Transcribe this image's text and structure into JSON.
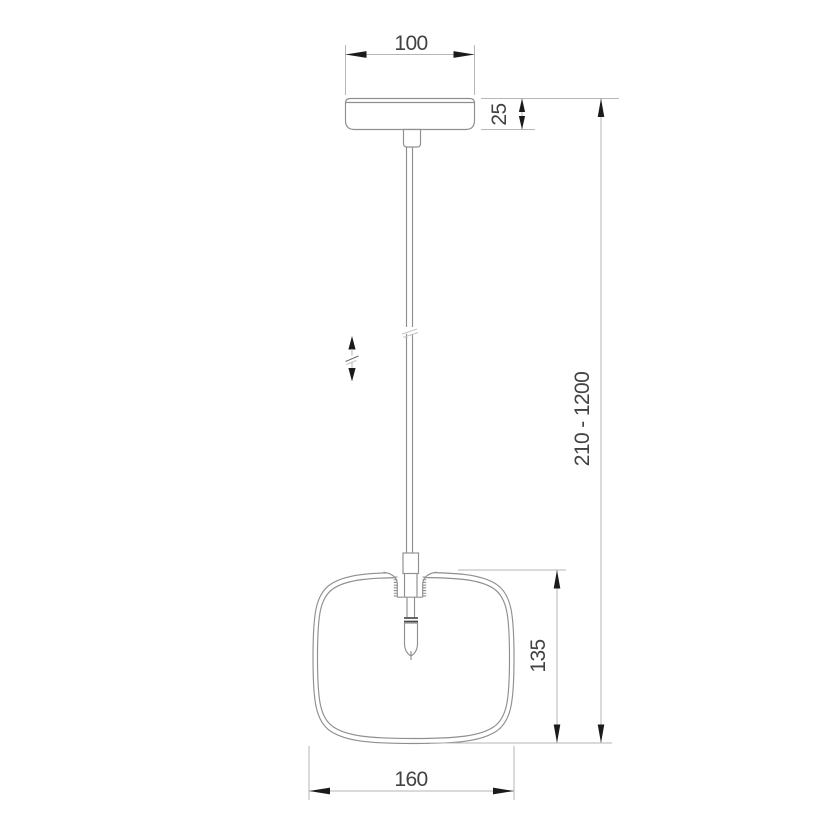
{
  "drawing": {
    "kind": "pendant-lamp-dimension-drawing",
    "dimensions": {
      "canopy_width": "100",
      "canopy_height": "25",
      "overall_height_range": "210 - 1200",
      "shade_height": "135",
      "shade_width": "160"
    },
    "icons": {
      "height_adjustable": "vertical-double-arrow-with-break"
    },
    "colors": {
      "background": "#ffffff",
      "object_line": "#8f8f8f",
      "dimension_line": "#b6b6b6",
      "arrow": "#1b1b1b",
      "text": "#424242"
    }
  }
}
